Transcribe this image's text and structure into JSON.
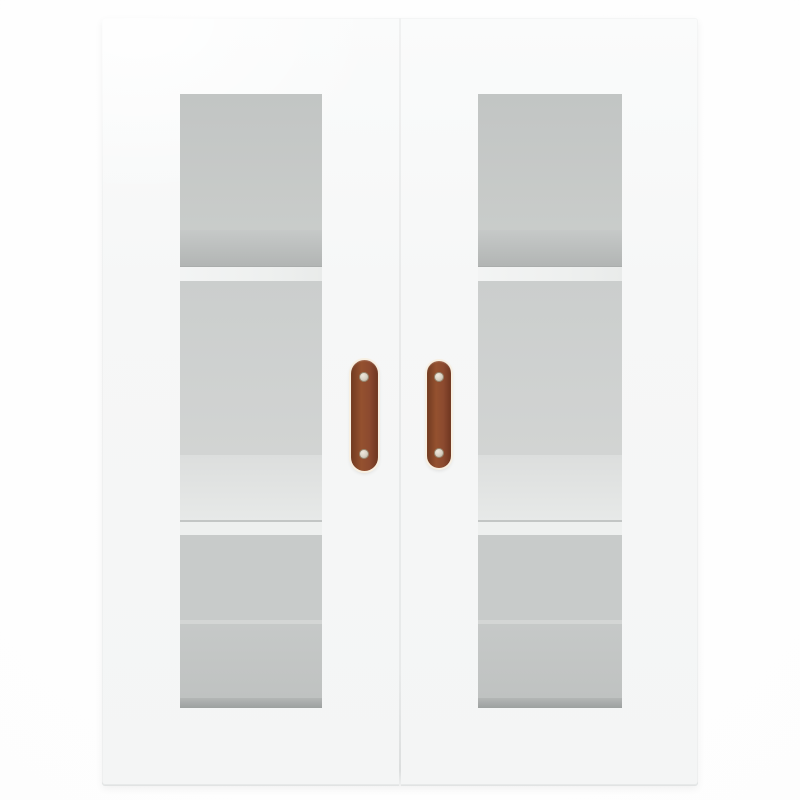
{
  "scene": {
    "description": "Product photograph of a white wall-mounted display cabinet with two glass-pane doors, interior shelves visible through the glass, and two vertical brown leather strap handles with metal rivets, on a plain white background.",
    "background_color": "#fdfdfd"
  },
  "cabinet": {
    "body_color": "#f6f7f7",
    "edge_color": "#e7e9e9",
    "seam_color": "#e9eaea",
    "door_count": 2
  },
  "glass": {
    "top_tint": "#c2c5c4",
    "mid_tint": "#cdd0cf",
    "shelf_color": "#eef0ef",
    "shadow_color": "#b2b5b4",
    "bottom_strip_color": "#b3b6b5",
    "visible_shelf_count": 2
  },
  "handles": {
    "count": 2,
    "leather_color": "#8c4a2f",
    "leather_dark": "#713a20",
    "highlight_color": "#f8f0e2",
    "rivet_color": "#d8d1c4",
    "rivet_ring": "#97876f",
    "rivets_per_handle": 2
  }
}
